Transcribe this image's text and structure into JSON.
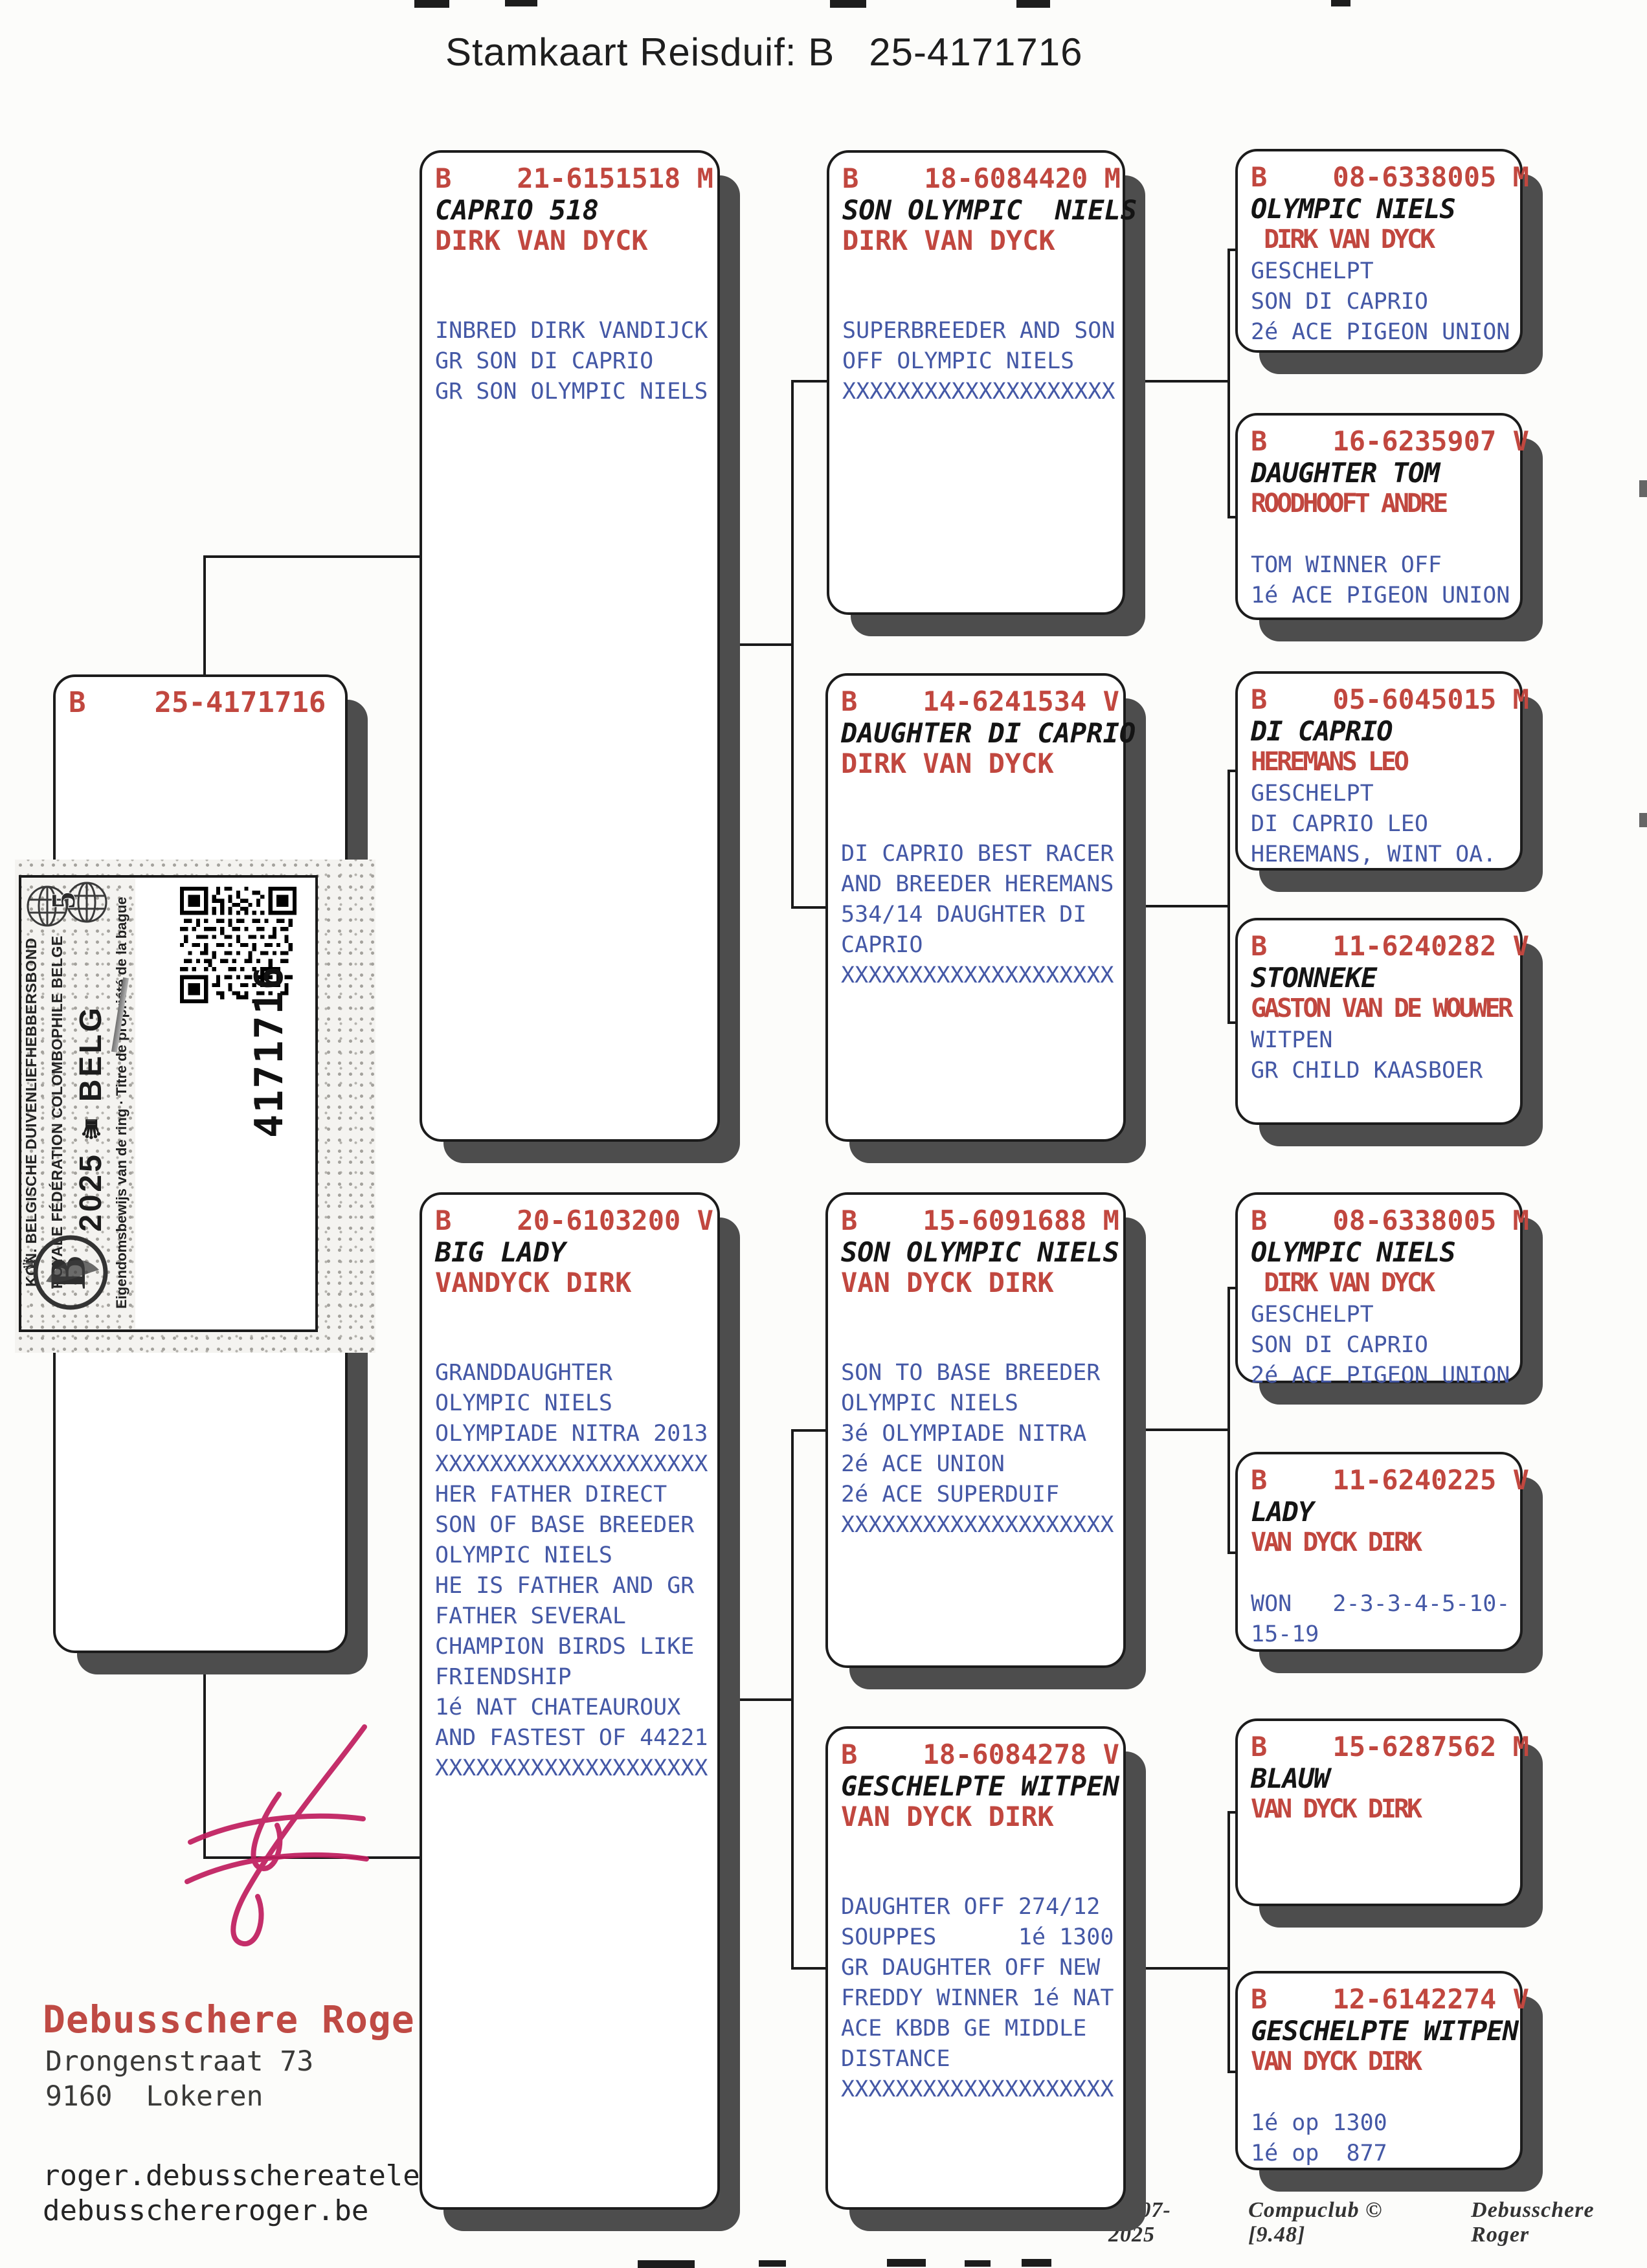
{
  "title": "Stamkaart Reisduif: B   25-4171716",
  "boxes": {
    "subject": {
      "ring": "B    25-4171716"
    },
    "father": {
      "ring": "B    21-6151518 M",
      "name": "CAPRIO 518",
      "fancier": "DIRK VAN DYCK",
      "notes": [
        "INBRED DIRK VANDIJCK",
        "GR SON DI CAPRIO",
        "GR SON OLYMPIC NIELS"
      ]
    },
    "mother": {
      "ring": "B    20-6103200 V",
      "name": "BIG LADY",
      "fancier": "VANDYCK DIRK",
      "notes": [
        "GRANDDAUGHTER",
        "OLYMPIC NIELS",
        "OLYMPIADE NITRA 2013",
        "XXXXXXXXXXXXXXXXXXXX",
        "HER FATHER DIRECT",
        "SON OF BASE BREEDER",
        "OLYMPIC NIELS",
        "HE IS FATHER AND GR",
        "FATHER SEVERAL",
        "CHAMPION BIRDS LIKE",
        "FRIENDSHIP",
        "1é NAT CHATEAUROUX",
        "AND FASTEST OF 44221",
        "XXXXXXXXXXXXXXXXXXXX"
      ]
    },
    "gp1": {
      "ring": "B    18-6084420 M",
      "name": "SON OLYMPIC  NIELS",
      "fancier": "DIRK VAN DYCK",
      "notes": [
        "SUPERBREEDER AND SON",
        "OFF OLYMPIC NIELS",
        "XXXXXXXXXXXXXXXXXXXX"
      ]
    },
    "gp2": {
      "ring": "B    14-6241534 V",
      "name": "DAUGHTER DI CAPRIO",
      "fancier": "DIRK VAN DYCK",
      "notes": [
        "DI CAPRIO BEST RACER",
        "AND BREEDER HEREMANS",
        "534/14 DAUGHTER DI",
        "CAPRIO",
        "XXXXXXXXXXXXXXXXXXXX"
      ]
    },
    "gp3": {
      "ring": "B    15-6091688 M",
      "name": "SON OLYMPIC NIELS",
      "fancier": "VAN DYCK DIRK",
      "notes": [
        "SON TO BASE BREEDER",
        "OLYMPIC NIELS",
        "3é OLYMPIADE NITRA",
        "2é ACE UNION",
        "2é ACE SUPERDUIF",
        "XXXXXXXXXXXXXXXXXXXX"
      ]
    },
    "gp4": {
      "ring": "B    18-6084278 V",
      "name": "GESCHELPTE WITPEN",
      "fancier": "VAN DYCK DIRK",
      "notes": [
        "DAUGHTER OFF 274/12",
        "SOUPPES      1é 1300",
        "GR DAUGHTER OFF NEW",
        "FREDDY WINNER 1é NAT",
        "ACE KBDB GE MIDDLE",
        "DISTANCE",
        "XXXXXXXXXXXXXXXXXXXX"
      ]
    },
    "ggp1": {
      "ring": "B    08-6338005 M",
      "name": "OLYMPIC NIELS",
      "fancier": " DIRK VAN DYCK",
      "notes": [
        "GESCHELPT",
        "SON DI CAPRIO",
        "2é ACE PIGEON UNION"
      ]
    },
    "ggp2": {
      "ring": "B    16-6235907 V",
      "name": "DAUGHTER TOM",
      "fancier": "ROODHOOFT ANDRE",
      "notes": [
        "TOM WINNER OFF",
        "1é ACE PIGEON UNION"
      ]
    },
    "ggp3": {
      "ring": "B    05-6045015 M",
      "name": "DI CAPRIO",
      "fancier": "HEREMANS LEO",
      "notes": [
        "GESCHELPT",
        "DI CAPRIO LEO",
        "HEREMANS, WINT OA."
      ]
    },
    "ggp4": {
      "ring": "B    11-6240282 V",
      "name": "STONNEKE",
      "fancier": "GASTON VAN DE WOUWER",
      "notes": [
        "WITPEN",
        "GR CHILD KAASBOER"
      ]
    },
    "ggp5": {
      "ring": "B    08-6338005 M",
      "name": "OLYMPIC NIELS",
      "fancier": " DIRK VAN DYCK",
      "notes": [
        "GESCHELPT",
        "SON DI CAPRIO",
        "2é ACE PIGEON UNION"
      ]
    },
    "ggp6": {
      "ring": "B    11-6240225 V",
      "name": "LADY",
      "fancier": "VAN DYCK DIRK",
      "notes": [
        "WON   2-3-3-4-5-10-",
        "15-19"
      ]
    },
    "ggp7": {
      "ring": "B    15-6287562 M",
      "name": "BLAUW",
      "fancier": "VAN DYCK DIRK",
      "notes": []
    },
    "ggp8": {
      "ring": "B    12-6142274 V",
      "name": "GESCHELPTE WITPEN",
      "fancier": "VAN DYCK DIRK",
      "notes": [
        "1é op 1300",
        "1é op  877"
      ]
    }
  },
  "ring_label": {
    "federation_line1": "KON. BELGISCHE DUIVENLIEFHEBBERSBOND",
    "federation_line2": "ROYALE FÉDÉRATION COLOMBOPHILE BELGE",
    "year": "2025",
    "crown": "♛",
    "country_code": "BELG",
    "ownership_text": "Eigendomsbewijs van de ring · Titre de propriété de la bague",
    "ring_number": "4171716"
  },
  "owner": {
    "name": "Debusschere Roger",
    "street": "Drongenstraat 73",
    "city": "9160  Lokeren",
    "email1": "roger.debusschereatelenet.be",
    "email2": "debusschereroger.be"
  },
  "footer": {
    "date": "24-07-2025",
    "software": "Compuclub © [9.48]",
    "printed_by": "Debusschere Roger"
  }
}
